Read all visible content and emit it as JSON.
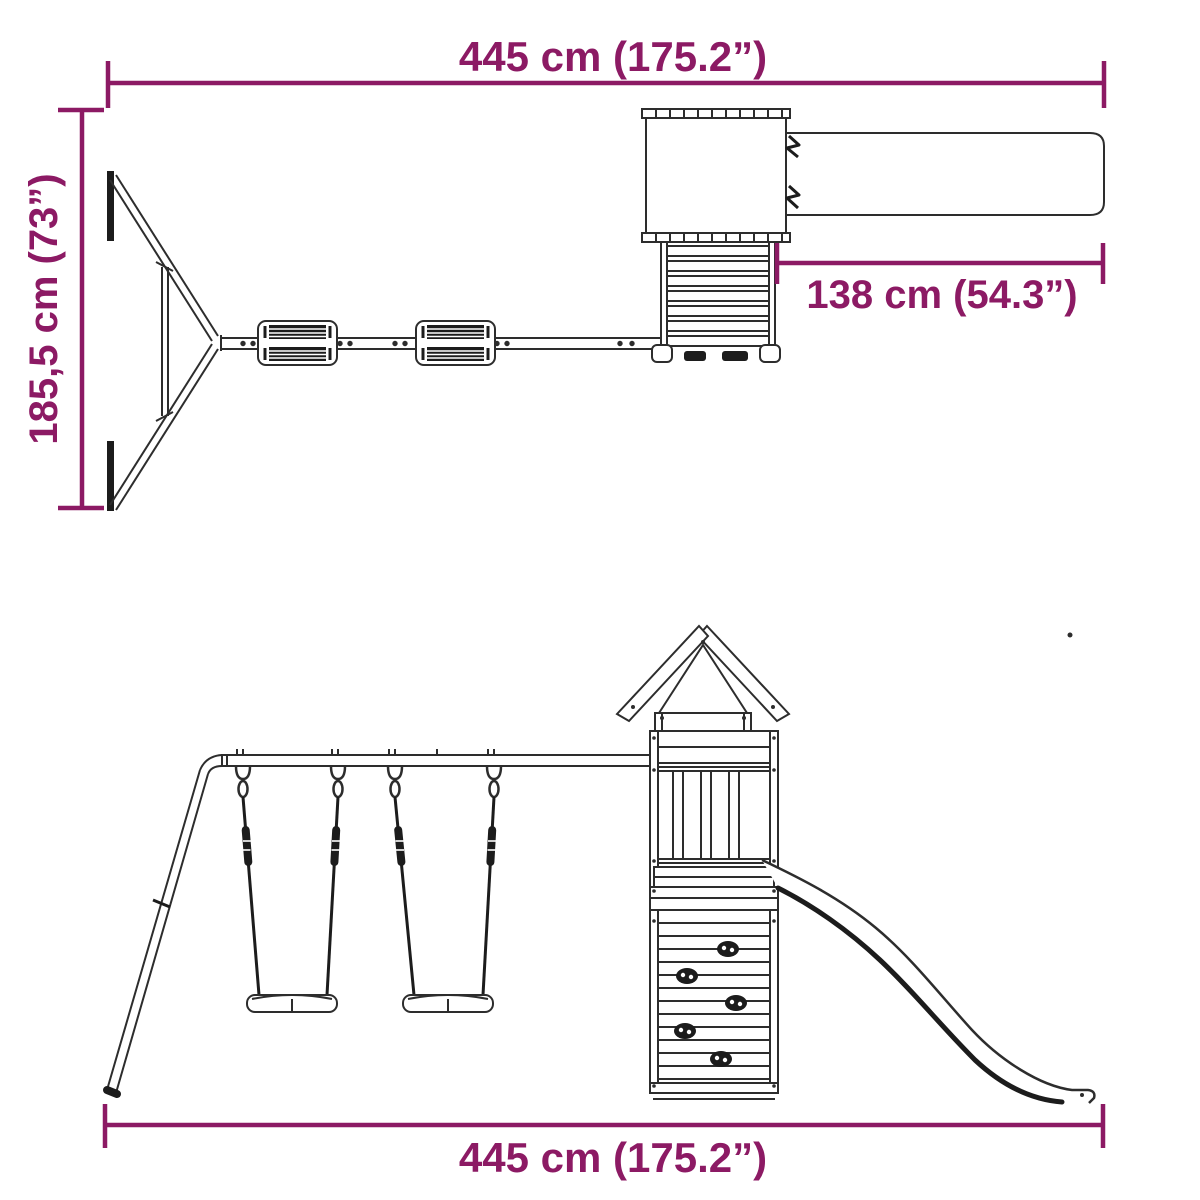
{
  "diagram": {
    "subject": "wooden-playset-with-swings-tower-and-slide",
    "background_color": "#FFFFFF",
    "dimension_color": "#8C1A64",
    "line_color": "#2D2D2D",
    "ink_color": "#1C1C1C",
    "views": {
      "top": {
        "dims": {
          "width": {
            "label": "445 cm (175.2”)",
            "value_cm": 445,
            "value_in": 175.2
          },
          "depth": {
            "label": "185,5 cm (73”)",
            "value_cm": 185.5,
            "value_in": 73
          },
          "slide": {
            "label": "138 cm (54.3”)",
            "value_cm": 138,
            "value_in": 54.3
          }
        }
      },
      "side": {
        "dims": {
          "width": {
            "label": "445 cm (175.2”)",
            "value_cm": 445,
            "value_in": 175.2
          }
        }
      }
    }
  }
}
